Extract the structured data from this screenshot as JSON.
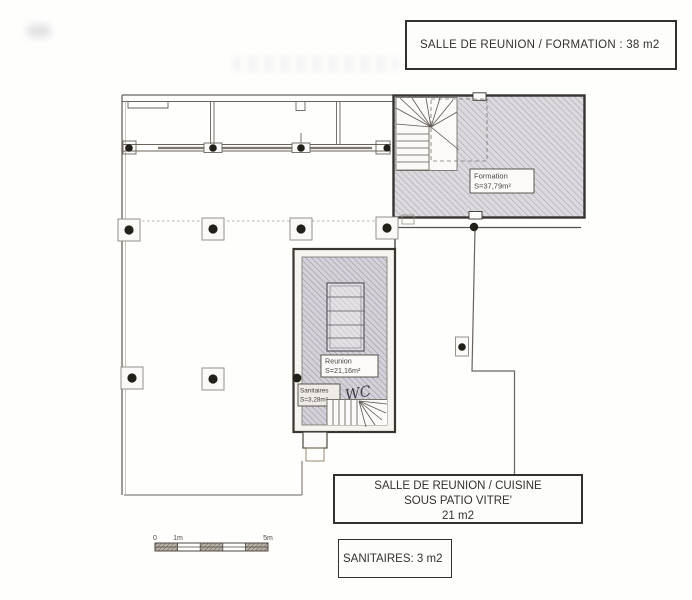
{
  "annotations": {
    "formation": {
      "text": "SALLE DE REUNION / FORMATION : 38 m2"
    },
    "cuisine": {
      "lines": [
        "SALLE DE REUNION / CUISINE",
        "SOUS PATIO VITRE'",
        "21 m2"
      ]
    },
    "sanitaires": {
      "text": "SANITAIRES: 3 m2"
    }
  },
  "plan": {
    "rooms": {
      "formation": {
        "name": "Formation",
        "area": "S=37,79m²"
      },
      "reunion": {
        "name": "Reunion",
        "area": "S=21,16m²"
      },
      "sanitaires": {
        "name": "Sanitaires",
        "area": "S=3,28m²"
      },
      "wc": {
        "name": "WC"
      }
    },
    "scale_bar": {
      "start": "0",
      "first": "1m",
      "end": "5m"
    }
  },
  "colors": {
    "paper": "#fdfdfb",
    "line": "#6a635c",
    "wall": "#38332e",
    "hatch_fill": "#dbd8de",
    "hatch_line": "#a5a0ae",
    "column_dot": "#232019"
  }
}
